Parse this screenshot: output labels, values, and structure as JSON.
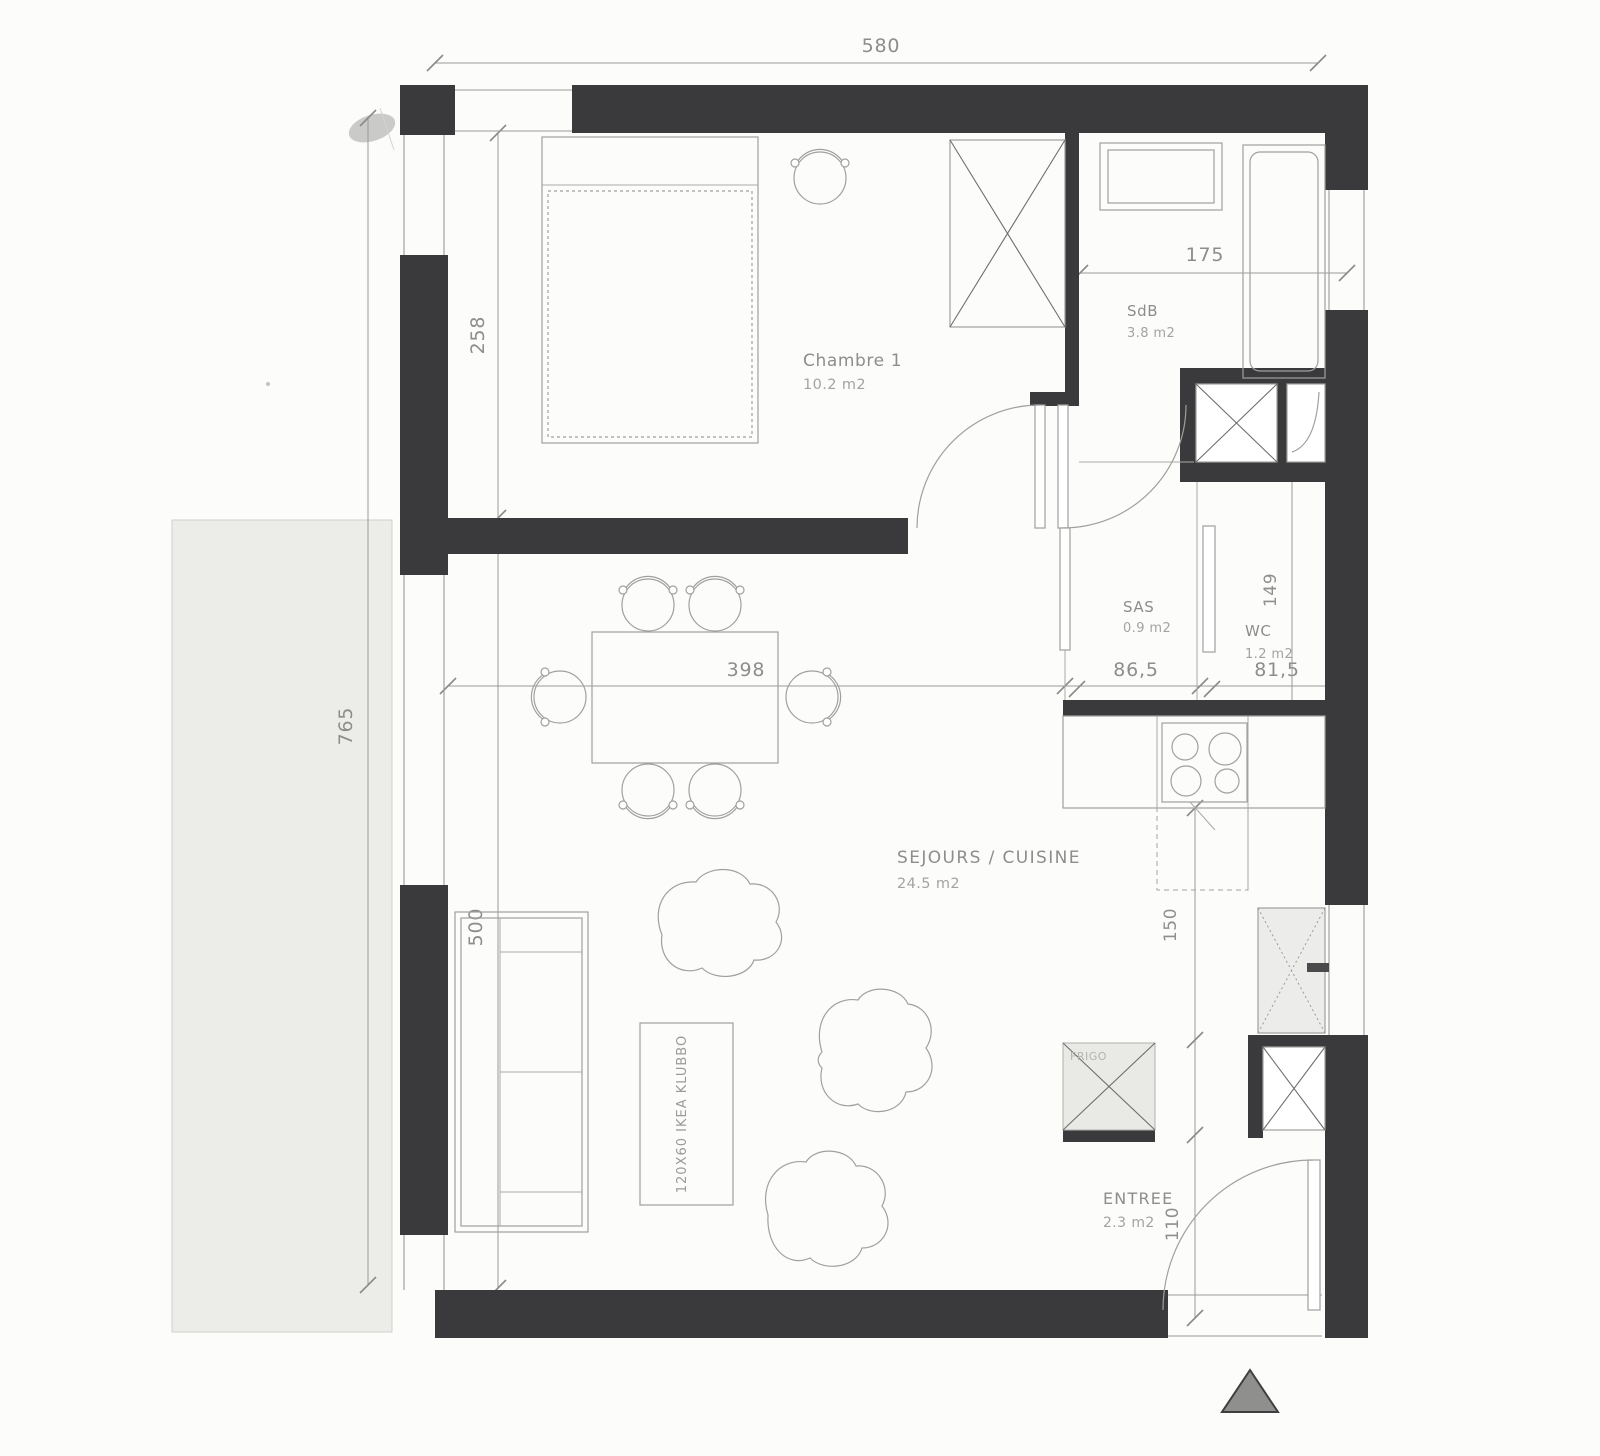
{
  "meta": {
    "drawing_type": "apartment floor plan (scanned)",
    "north_marker": "triangle-up"
  },
  "rooms": [
    {
      "name": "Chambre 1",
      "area": "10.2 m2"
    },
    {
      "name": "SdB",
      "area": "3.8 m2"
    },
    {
      "name": "SAS",
      "area": "0.9 m2"
    },
    {
      "name": "WC",
      "area": "1.2 m2"
    },
    {
      "name": "SEJOURS / CUISINE",
      "area": "24.5 m2"
    },
    {
      "name": "ENTREE",
      "area": "2.3 m2"
    }
  ],
  "dimensions": {
    "overall_width": "580",
    "outdoor_height": "765",
    "bedroom_depth": "258",
    "living_depth": "500",
    "bathroom_width": "175",
    "living_width": "398",
    "sas_width": "86,5",
    "wc_width": "81,5",
    "wc_depth": "149",
    "kitchen_run": "150",
    "entry_depth": "110"
  },
  "annotations": {
    "coffee_table": "120X60 IKEA KLUBBO",
    "fridge": "FRIGO"
  },
  "colors": {
    "wall": "#3a3a3c",
    "line": "#9c9c9a",
    "terrace": "#ecece9",
    "text": "#8d8d8b"
  }
}
